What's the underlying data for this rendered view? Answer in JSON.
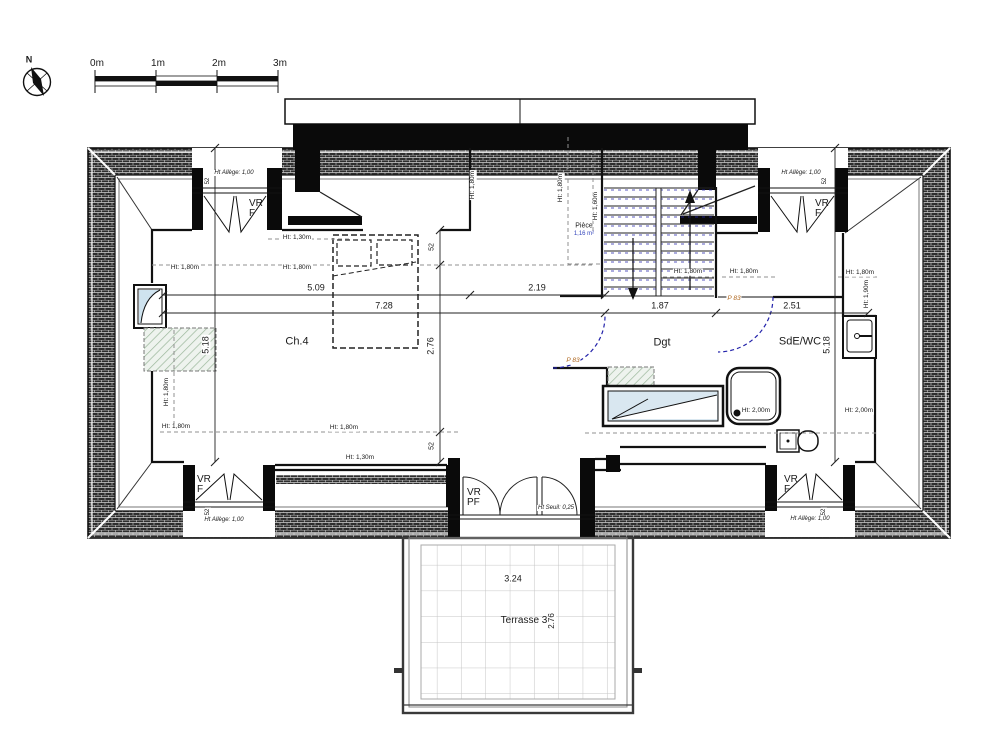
{
  "labels": {
    "north": "N",
    "scale": [
      "0m",
      "1m",
      "2m",
      "3m"
    ],
    "rooms": {
      "ch4": "Ch.4",
      "dgt": "Dgt",
      "sdewc": "SdE/WC",
      "piece": "Pièce",
      "piece_area": "1,16 m²",
      "terrace": "Terrasse 3"
    },
    "dims": {
      "d509": "5.09",
      "d219": "2.19",
      "d728": "7.28",
      "d187": "1.87",
      "d251": "2.51",
      "d518": "5.18",
      "d276": "2.76",
      "d52": "52",
      "d324": "3.24"
    },
    "heights": {
      "h130": "Ht: 1,30m",
      "h160": "Ht: 1,60m",
      "h180": "Ht: 1,80m",
      "h190": "Ht: 1,90m",
      "h200": "Ht: 2,00m"
    },
    "windows": {
      "vrf": "VR\nF",
      "vrpf": "VR\nPF",
      "allege": "Ht Allège: 1,00",
      "seuil": "Ht Seuil: 0,25"
    },
    "doors": {
      "p83": "P 83"
    }
  },
  "colors": {
    "wall_hatch": "#2e2e2e",
    "green_hatch": "#9cb89c",
    "glazing": "#cfe3ef",
    "bathtub_fill": "#d9e7f0",
    "door_swing": "#2222aa",
    "door_label": "#b06820",
    "area_label": "#3344bb"
  }
}
